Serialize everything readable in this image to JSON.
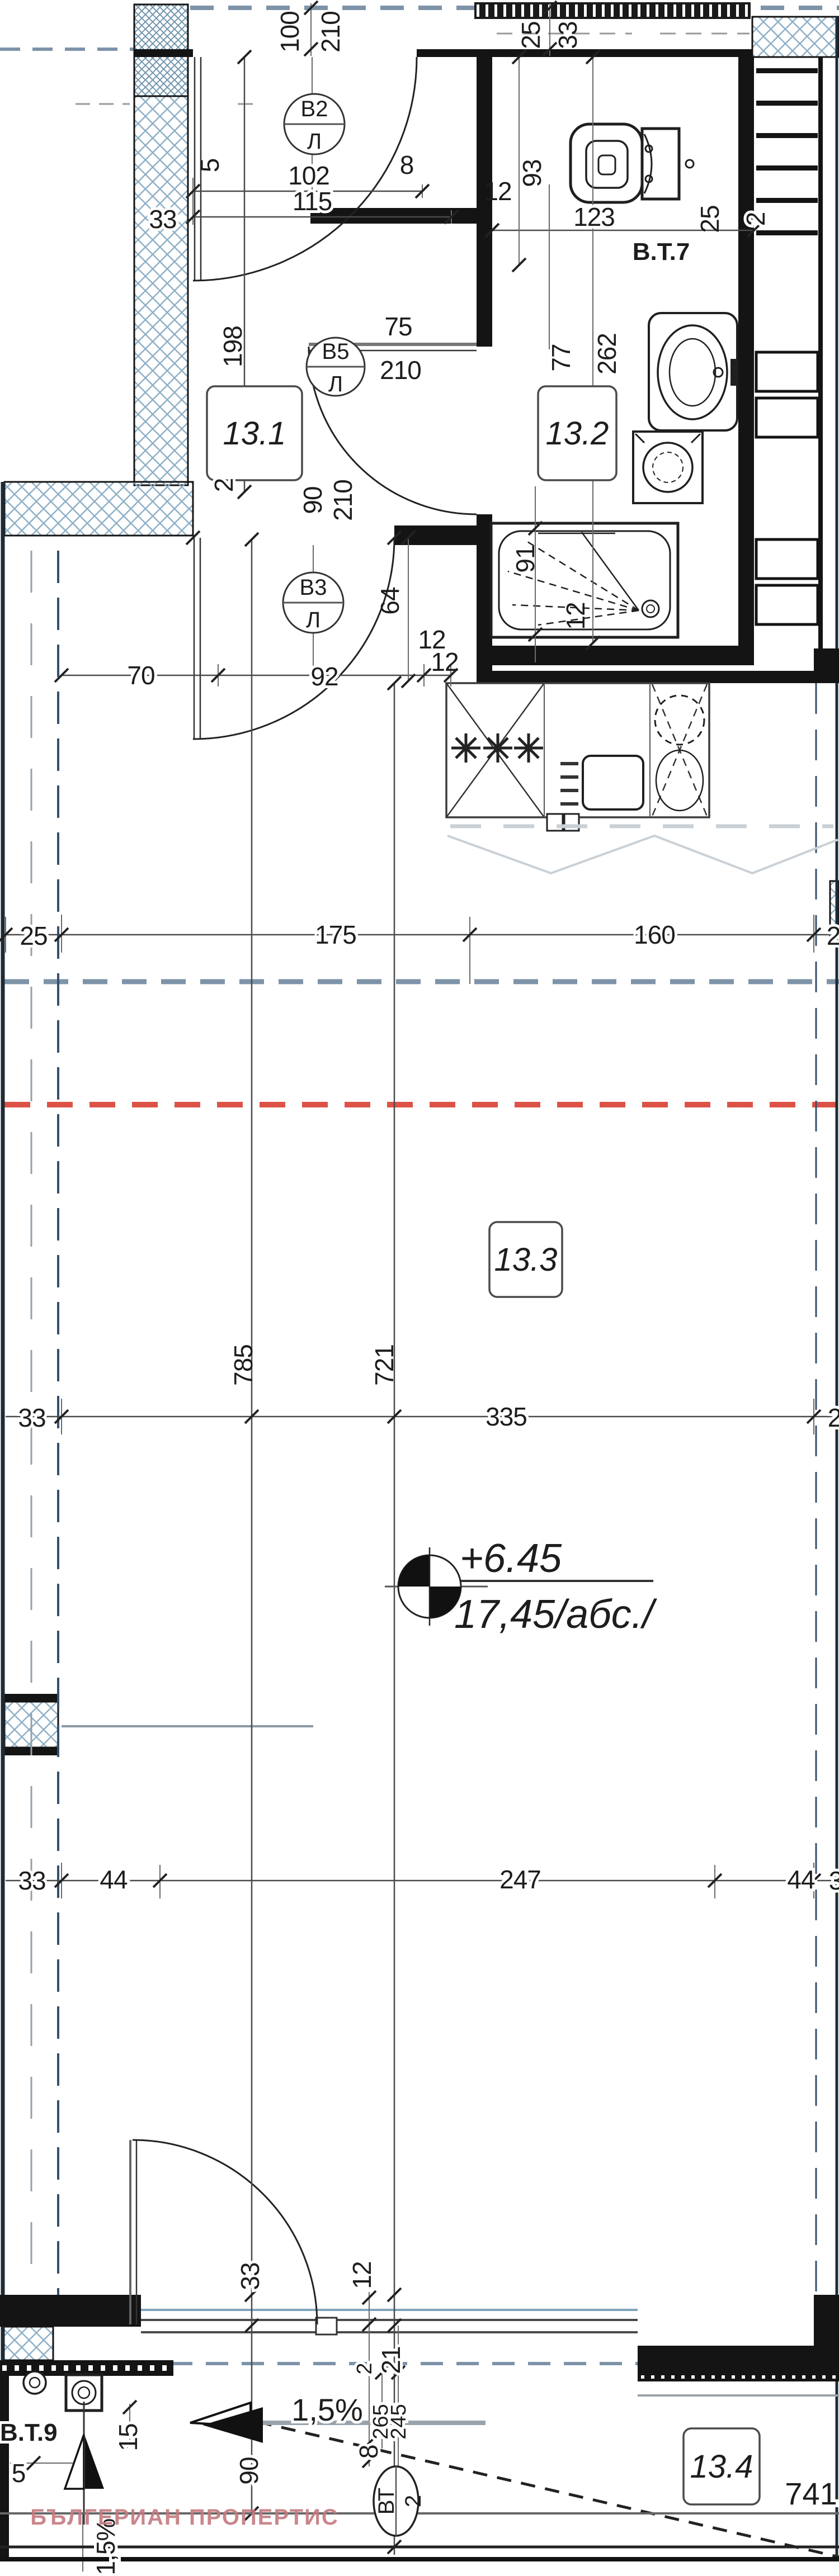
{
  "watermark": {
    "text": "БЪЛГЕРИАН ПРОПЕРТИС",
    "color": "#c4797f"
  },
  "level": {
    "relative": "+6.45",
    "absolute": "17,45/абс./"
  },
  "slope": {
    "percent": "1,5%"
  },
  "rooms": [
    {
      "id": "13.1"
    },
    {
      "id": "13.2"
    },
    {
      "id": "13.3"
    },
    {
      "id": "13.4"
    }
  ],
  "vents": [
    {
      "code": "В2",
      "sub": "Л"
    },
    {
      "code": "В5",
      "sub": "Л"
    },
    {
      "code": "В3",
      "sub": "Л"
    }
  ],
  "labels": {
    "vt7": "В.Т.7",
    "vt9": "В.Т.9",
    "vt2a": "ВТ",
    "vt2b": "2"
  },
  "dims": {
    "n2": "2",
    "n3": "3",
    "n5": "5",
    "n8": "8",
    "n12": "12",
    "n15": "15",
    "n21": "21",
    "n25": "25",
    "n33": "33",
    "n44": "44",
    "n64": "64",
    "n70": "70",
    "n75": "75",
    "n77": "77",
    "n90": "90",
    "n91": "91",
    "n92": "92",
    "n93": "93",
    "n100": "100",
    "n102": "102",
    "n115": "115",
    "n123": "123",
    "n160": "160",
    "n175": "175",
    "n198": "198",
    "n210": "210",
    "n245": "245",
    "n247": "247",
    "n262": "262",
    "n265": "265",
    "n335": "335",
    "n721": "721",
    "n741": "741",
    "n785": "785"
  },
  "colors": {
    "accent_red": "#dd5246",
    "hatch_blue": "#8fb0c7",
    "guide_gray": "#7d93a8"
  }
}
